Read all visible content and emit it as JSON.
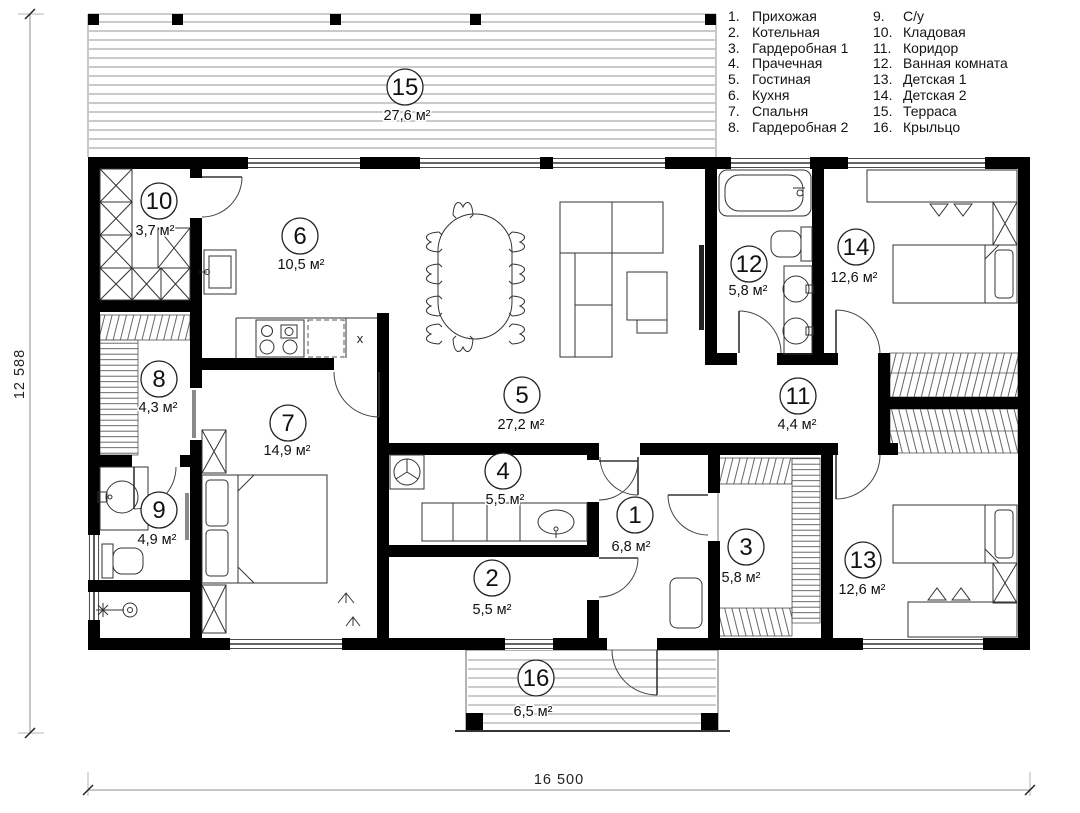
{
  "legend": {
    "items": [
      {
        "num": "1.",
        "label": "Прихожая"
      },
      {
        "num": "2.",
        "label": "Котельная"
      },
      {
        "num": "3.",
        "label": "Гардеробная 1"
      },
      {
        "num": "4.",
        "label": "Прачечная"
      },
      {
        "num": "5.",
        "label": "Гостиная"
      },
      {
        "num": "6.",
        "label": "Кухня"
      },
      {
        "num": "7.",
        "label": "Спальня"
      },
      {
        "num": "8.",
        "label": "Гардеробная 2"
      },
      {
        "num": "9.",
        "label": "С/у"
      },
      {
        "num": "10.",
        "label": "Кладовая"
      },
      {
        "num": "11.",
        "label": "Коридор"
      },
      {
        "num": "12.",
        "label": "Ванная комната"
      },
      {
        "num": "13.",
        "label": "Детская 1"
      },
      {
        "num": "14.",
        "label": "Детская 2"
      },
      {
        "num": "15.",
        "label": "Терраса"
      },
      {
        "num": "16.",
        "label": "Крыльцо"
      }
    ]
  },
  "rooms": [
    {
      "number": "1",
      "name": "Прихожая",
      "area": "6,8 м²"
    },
    {
      "number": "2",
      "name": "Котельная",
      "area": "5,5 м²"
    },
    {
      "number": "3",
      "name": "Гардеробная 1",
      "area": "5,8 м²"
    },
    {
      "number": "4",
      "name": "Прачечная",
      "area": "5,5 м²"
    },
    {
      "number": "5",
      "name": "Гостиная",
      "area": "27,2 м²"
    },
    {
      "number": "6",
      "name": "Кухня",
      "area": "10,5 м²"
    },
    {
      "number": "7",
      "name": "Спальня",
      "area": "14,9 м²"
    },
    {
      "number": "8",
      "name": "Гардеробная 2",
      "area": "4,3 м²"
    },
    {
      "number": "9",
      "name": "С/у",
      "area": "4,9 м²"
    },
    {
      "number": "10",
      "name": "Кладовая",
      "area": "3,7 м²"
    },
    {
      "number": "11",
      "name": "Коридор",
      "area": "4,4 м²"
    },
    {
      "number": "12",
      "name": "Ванная комната",
      "area": "5,8 м²"
    },
    {
      "number": "13",
      "name": "Детская 1",
      "area": "12,6 м²"
    },
    {
      "number": "14",
      "name": "Детская 2",
      "area": "12,6 м²"
    },
    {
      "number": "15",
      "name": "Терраса",
      "area": "27,6 м²"
    },
    {
      "number": "16",
      "name": "Крыльцо",
      "area": "6,5 м²"
    }
  ],
  "dimensions": {
    "width_label": "16 500",
    "height_label": "12 588"
  },
  "plan": {
    "kitchen_unit_label": "x"
  },
  "colors": {
    "wall": "#000000",
    "thin_line": "#333333",
    "terrace_plank": "#ababab"
  }
}
